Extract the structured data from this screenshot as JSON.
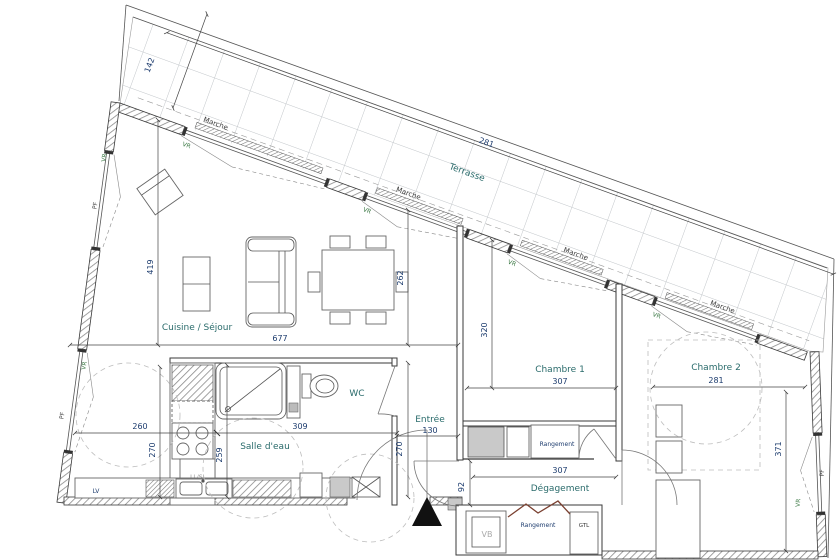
{
  "plan": {
    "labels": {
      "terrasse": "Terrasse",
      "cuisine_sejour": "Cuisine / Séjour",
      "salle_eau": "Salle d'eau",
      "wc": "WC",
      "entree": "Entrée",
      "chambre1": "Chambre 1",
      "chambre2": "Chambre 2",
      "degagement": "Dégagement",
      "rangement": "Rangement",
      "gtl": "GTL",
      "vb": "VB",
      "lv": "LV",
      "ll_sl": "LL/SL"
    },
    "annotations": {
      "marche": "Marche",
      "vr": "VR",
      "pf": "PF"
    },
    "dims": {
      "terrasse_length": "281",
      "terrasse_width": "142",
      "sejour_width": "677",
      "sejour_height": "419",
      "sejour_depth": "262",
      "cuisine_width": "260",
      "cuisine_depth": "270",
      "salle_eau_width": "309",
      "salle_eau_height": "259",
      "entree_width": "130",
      "entree_depth": "270",
      "chambre1_width": "307",
      "chambre1_height": "320",
      "chambre2_width": "281",
      "chambre2_height": "371",
      "degagement_width": "307",
      "degagement_height": "92"
    },
    "colors": {
      "room_label": "#2a6b6b",
      "dim": "#1d3c6e",
      "vr": "#3d7a46",
      "annotation": "#3b3b3b",
      "fold_door": "#7a4030",
      "wall": "#3a3a3a",
      "tile": "#c2c6ca",
      "dashed_circle": "#bdbdbd"
    }
  }
}
